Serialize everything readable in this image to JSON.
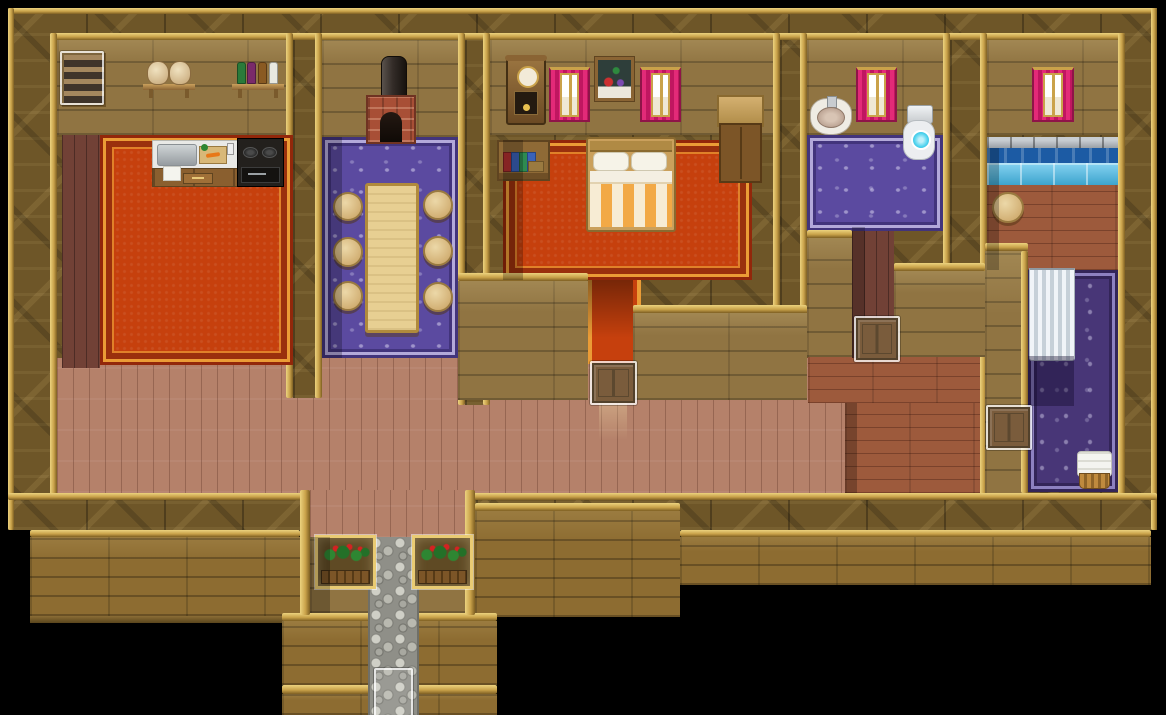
{
  "meta": {
    "title": "Top-down RPG house interior map",
    "style": "16-bit pixel tile art, RPG Maker style",
    "view": "top-down interior with black backdrop"
  },
  "palette": {
    "black_bg": "#000000",
    "wall_dark": "#6e5628",
    "trim_gold": "#c9a24a",
    "trim_gold_light": "#ecd27e",
    "trim_gold_dark": "#7e5f22",
    "room_wall_face": "#907442",
    "lower_wall": "#8d6c31",
    "hall_floor": "#b5816a",
    "dark_floor": "#714136",
    "red_floor": "#9d5a3c",
    "carpet_red": "#c6400d",
    "carpet_red_dark": "#92270a",
    "carpet_red_gold": "#eb9c36",
    "carpet_purple": "#5b4aa0",
    "carpet_purple_dark": "#42347c",
    "carpet_purple_light": "#b3a9da",
    "carpet_deep_purple": "#483677",
    "water_dark": "#1c5ba4",
    "water_light": "#45bbea",
    "stone_ledge_c": "#9aa0a6",
    "stone_path_c": "#8f8f88",
    "curtain_pink": "#e32a78",
    "counter_top": "#e9e9e6",
    "table_top": "#e7cf92",
    "brick": "#a84f36",
    "blanket_orange": "#f2a946",
    "toilet_cyan": "#4cd2ee",
    "wicker": "#bf8a3e",
    "flower_red": "#d42222"
  },
  "rooms": {
    "kitchen": {
      "label": "Kitchen",
      "floor": "red ornate carpet with dark plank strip",
      "furniture": [
        "Staircase",
        "Supply shelf with two sacks",
        "Shelf with four bottles",
        "Kitchen counter with sink and cutting board",
        "Cooking stove"
      ]
    },
    "dining_room": {
      "label": "Dining room",
      "floor": "purple damask carpet",
      "furniture": [
        "Brick fireplace",
        "Chimney pipe",
        "Long dining table",
        "Round stool"
      ]
    },
    "bedroom": {
      "label": "Bedroom",
      "floor": "red ornate carpet",
      "furniture": [
        "Pendulum wall clock",
        "Curtained window",
        "Still-life painting",
        "Bookshelf",
        "Double bed with striped blanket",
        "Wardrobe cabinet"
      ]
    },
    "toilet_room": {
      "label": "Toilet room",
      "floor": "purple damask rug",
      "furniture": [
        "Wall wash basin",
        "Curtained window",
        "Flush toilet"
      ]
    },
    "bath_room": {
      "label": "Bath room",
      "floor": "wood planks and deep purple rug",
      "furniture": [
        "Curtained window",
        "Heated bath pool",
        "Bathing stool",
        "White shower curtain",
        "Towel basket"
      ]
    },
    "main_hall": {
      "label": "Main hall",
      "floor": "light wood planks"
    },
    "east_hall": {
      "label": "East hallway",
      "floor": "dark red wood planks"
    },
    "entrance": {
      "label": "Entrance porch",
      "furniture": [
        "Flower box",
        "Stone path"
      ]
    }
  },
  "events": {
    "stairs": {
      "label": "Stairs up (map transfer)"
    },
    "bedroom_door": {
      "label": "Bedroom door (closed)"
    },
    "hallway_door": {
      "label": "Toilet hallway door (closed)"
    },
    "bath_door": {
      "label": "Bath room door (closed)"
    },
    "exit": {
      "label": "South exit (map transfer)"
    },
    "flower_box_left": {
      "label": "Flower box"
    },
    "flower_box_right": {
      "label": "Flower box"
    }
  }
}
